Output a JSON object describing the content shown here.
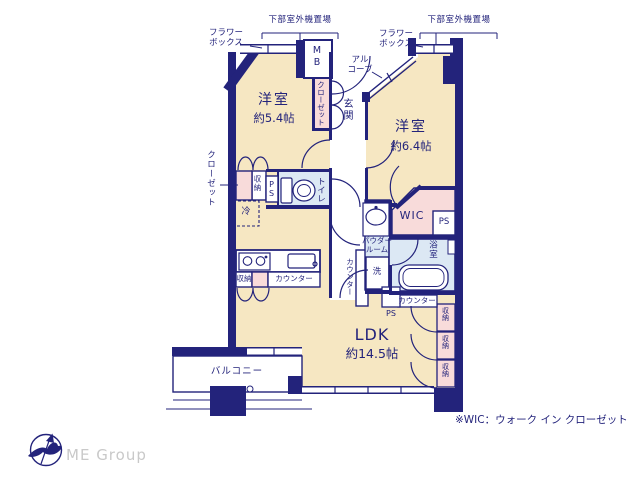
{
  "colors": {
    "wall": "#23237b",
    "floor": "#f6e7c2",
    "closet_pink": "#f8dbda",
    "wet_blue": "#dce8f4",
    "brand_gray": "#c9c9c9"
  },
  "rooms": {
    "bedroom1_name": "洋室",
    "bedroom1_size": "約5.4帖",
    "bedroom2_name": "洋室",
    "bedroom2_size": "約6.4帖",
    "ldk_name": "LDK",
    "ldk_size": "約14.5帖",
    "balcony": "バルコニー",
    "entrance": "玄関",
    "toilet": "トイレ",
    "bath": "浴室",
    "powder_room": "パウダー\nルーム",
    "wic": "WIC"
  },
  "labels": {
    "outdoor_unit": "下部室外機置場",
    "flower_box": "フラワー\nボックス",
    "alcove": "アル\nコーブ",
    "mb": "MB",
    "closet": "クローゼット",
    "storage": "収納",
    "ps": "PS",
    "fridge": "冷",
    "counter": "カウンター",
    "washer": "洗"
  },
  "footnote": "※WIC：ウォーク イン クローゼット",
  "brand": "ME Group"
}
